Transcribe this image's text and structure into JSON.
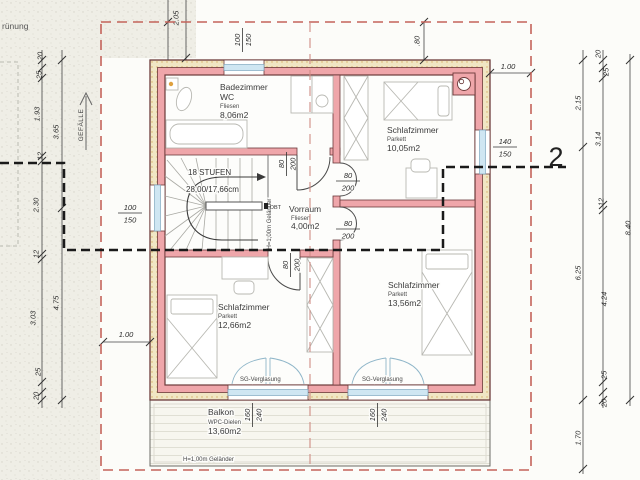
{
  "site": {
    "greening": "rünung",
    "slope": "GEFÄLLE"
  },
  "section_label": "2",
  "stair": {
    "line1": "18 STUFEN",
    "line2": "28,00/17,66cm",
    "railing": "H=1,00m Geländer",
    "hatch": "DBT"
  },
  "rooms": {
    "bath": {
      "name": "Badezimmer",
      "sub": "WC",
      "floor": "Fliesen",
      "area": "8,06m2"
    },
    "bed_tr": {
      "name": "Schlafzimmer",
      "floor": "Parkett",
      "area": "10,05m2"
    },
    "vorraum": {
      "name": "Vorraum",
      "floor": "Fliesen",
      "area": "4,00m2"
    },
    "bed_bl": {
      "name": "Schlafzimmer",
      "floor": "Parkett",
      "area": "12,66m2"
    },
    "bed_br": {
      "name": "Schlafzimmer",
      "floor": "Parkett",
      "area": "13,56m2"
    },
    "balcony": {
      "name": "Balkon",
      "floor": "WPC-Dielen",
      "area": "13,60m2",
      "railing": "H=1,00m Geländer"
    }
  },
  "glazing_label": "SG-Verglasung",
  "openings": {
    "door_w": "80",
    "door_h": "200",
    "win_top_w": "100",
    "win_top_h": "150",
    "win_left_w": "100",
    "win_left_h": "150",
    "win_right_w": "140",
    "win_right_h": "150",
    "bal_door_w": "160",
    "bal_door_h": "240"
  },
  "dims": {
    "top": "2.05",
    "roof_top": ".80",
    "roof_right": "1.00",
    "roof_left": "1.00",
    "left_inner": [
      "20",
      "25",
      "1.93",
      "12",
      "2.30",
      "12",
      "3.03",
      "25",
      "20"
    ],
    "left_outer": [
      "3.65",
      "4.75"
    ],
    "right_inner": [
      "20",
      "25",
      "3.14",
      "12",
      "4.24",
      "25",
      "20"
    ],
    "right_mid": [
      "2.15",
      "6.25",
      "1.70"
    ],
    "right_total": "8.40"
  },
  "colors": {
    "wall": "#efa6aa",
    "outline": "#6b3a3a",
    "insulation": "#f0e6c4",
    "window_glass": "#cfe6f2",
    "roof_dash": "#c4635a",
    "section_line": "#1a1a1a"
  }
}
